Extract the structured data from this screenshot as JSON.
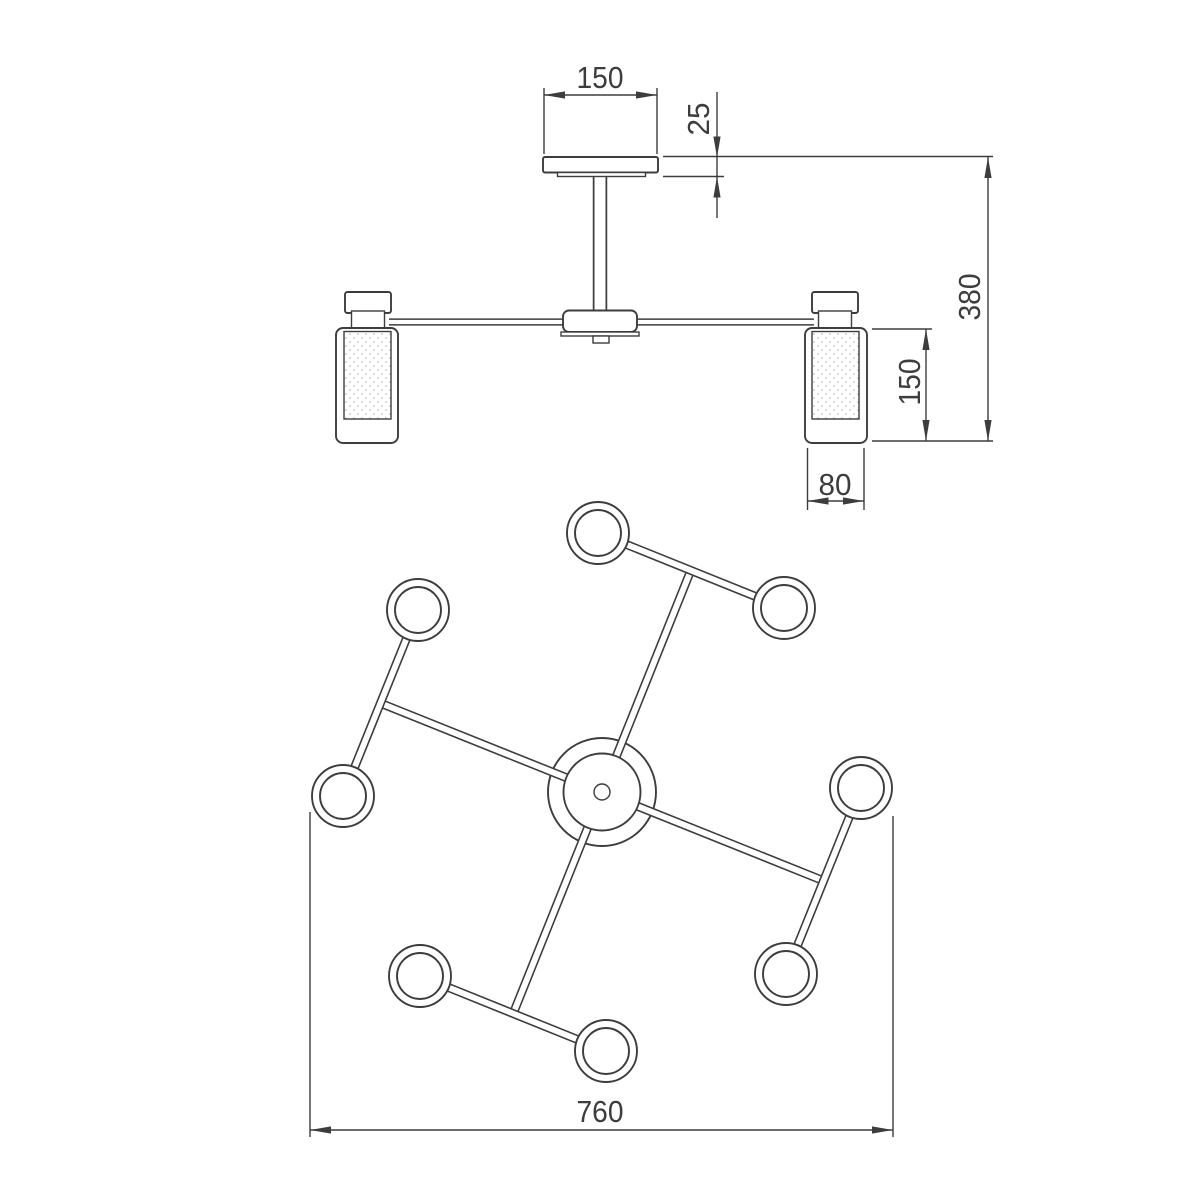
{
  "page": {
    "background": "#ffffff"
  },
  "drawing": {
    "line_color": "#3d3d3d",
    "dimension_color": "#3d3d3d",
    "stipple_color": "#adadad",
    "front_view": {
      "dimensions": {
        "canopy_width": "150",
        "canopy_thickness": "25",
        "overall_height": "380",
        "shade_height": "150",
        "shade_width": "80"
      }
    },
    "top_view": {
      "dimensions": {
        "overall_width": "760"
      }
    }
  }
}
